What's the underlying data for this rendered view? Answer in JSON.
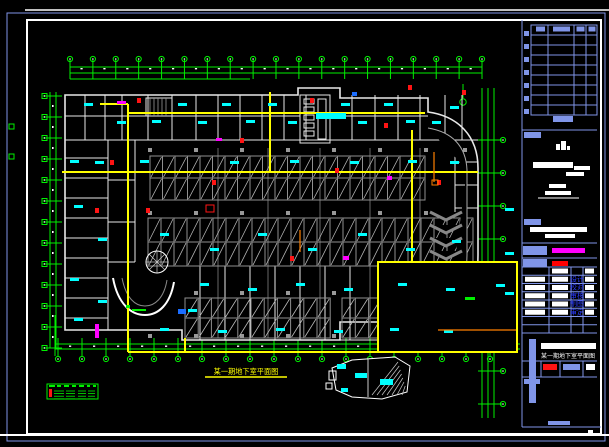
{
  "app": {
    "type": "cad-sheet-viewer",
    "background": "#000000"
  },
  "colors": {
    "frame_blue": "#8095e8",
    "sheet_white": "#ffffff",
    "grid_green": "#00f000",
    "wall_white": "#e8e8e8",
    "stall_gray": "#909090",
    "joint_gray": "#4a4a4a",
    "trunk_yellow": "#ffff00",
    "label_cyan": "#00ffff",
    "device_red": "#ff1414",
    "device_magenta": "#ff00ff",
    "device_orange": "#ff8000",
    "device_blue": "#1b6dff",
    "role_text_blue": "#2b3cff"
  },
  "caption": {
    "text": "某一期地下室平面图"
  },
  "legend": {
    "row_count": 4
  },
  "grids": {
    "top": {
      "bubbles": 19
    },
    "left": {
      "bubbles": 13
    },
    "right": {
      "bubbles": 9
    },
    "bottom": {
      "bubbles": 19
    }
  },
  "parking_rows": [
    {
      "x": 150,
      "y": 156,
      "stalls": 22,
      "stall_w": 12.5,
      "stall_h": 22
    },
    {
      "x": 148,
      "y": 218,
      "stalls": 25,
      "stall_w": 13,
      "stall_h": 24
    },
    {
      "x": 185,
      "y": 298,
      "stalls": 11,
      "stall_w": 13.2,
      "stall_h": 20
    },
    {
      "x": 342,
      "y": 298,
      "stalls": 9,
      "stall_w": 13.3,
      "stall_h": 20
    }
  ],
  "title_block": {
    "revision_table": {
      "columns": 4,
      "rows": 9,
      "margin_squares": 7
    },
    "roles": [
      "设计",
      "校对",
      "审核",
      "制图",
      "审定"
    ],
    "drawing_name": "某一期地下室平面图",
    "accent_bars": {
      "magenta": "#ff00ff",
      "red": "#ff0000"
    }
  }
}
